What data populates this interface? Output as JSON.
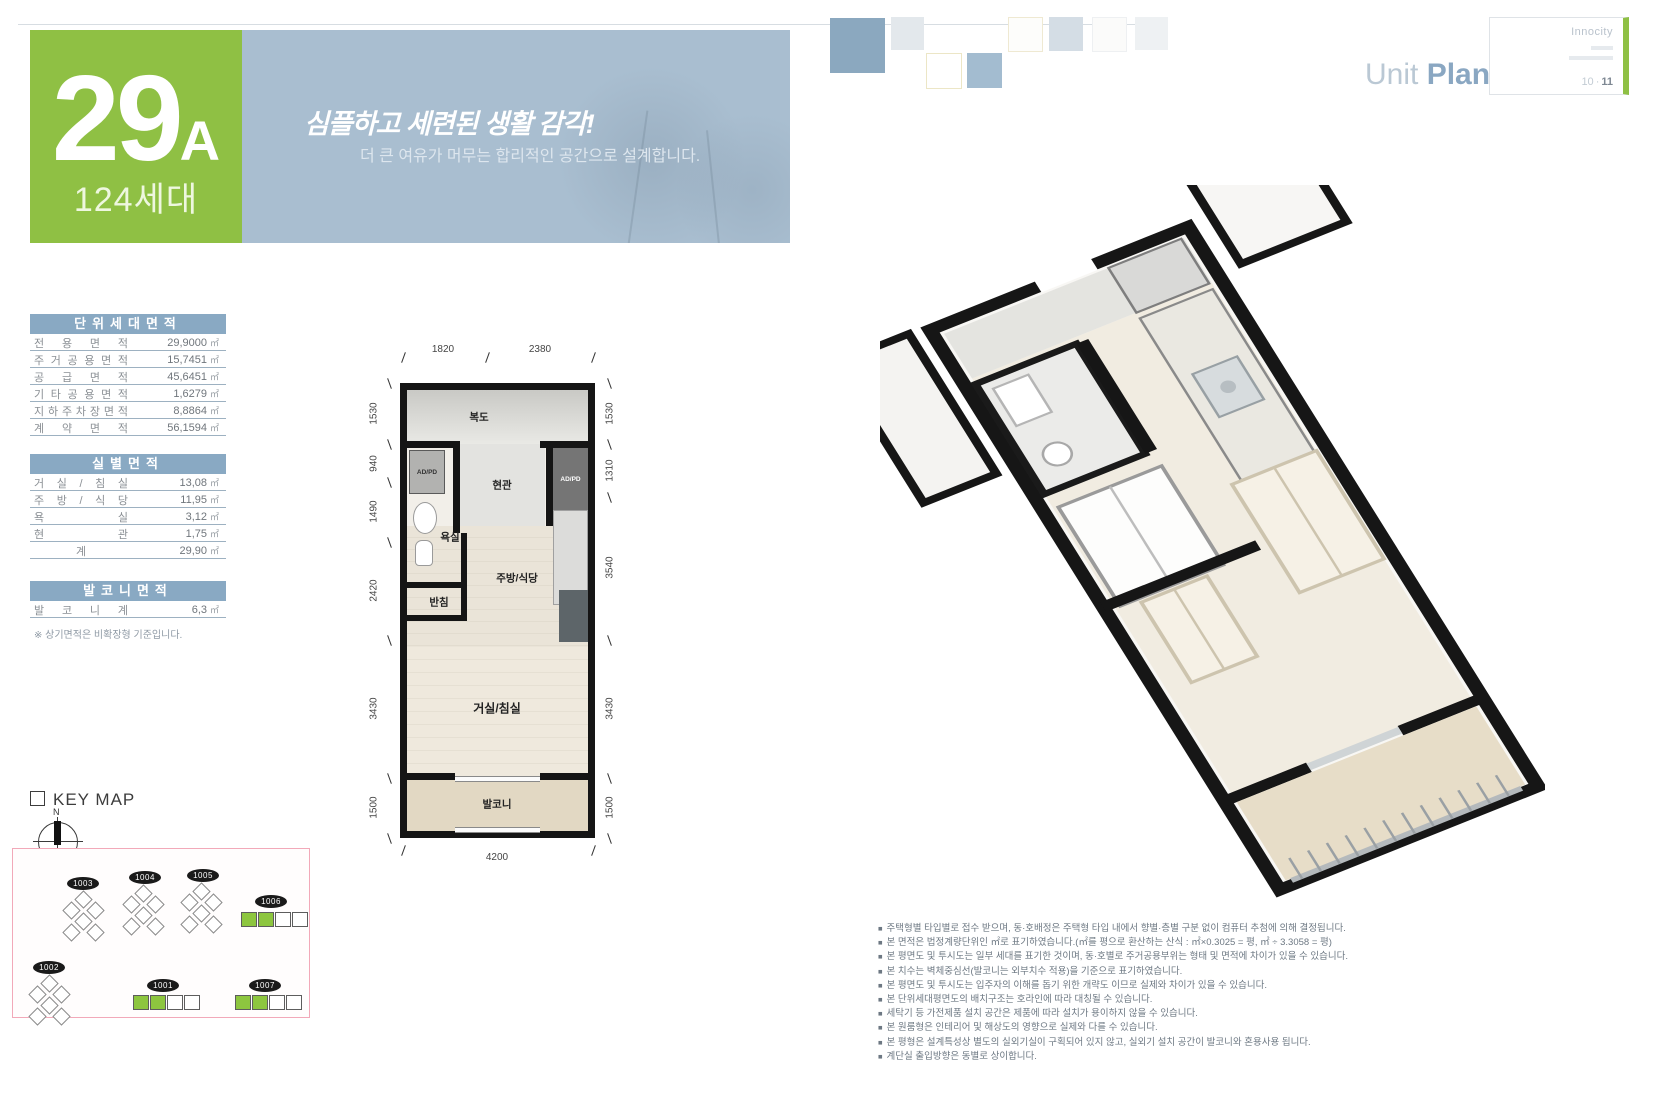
{
  "badge": {
    "number": "29",
    "letter": "A",
    "households": "124세대"
  },
  "banner": {
    "headline": "심플하고 세련된 생활 감각!",
    "subline": "더 큰 여유가 머무는 합리적인 공간으로 설계합니다."
  },
  "header": {
    "unit_word": "Unit",
    "plan_word": "Plan",
    "brand": "Innocity",
    "page_left": "10",
    "page_sep": "·",
    "page_right": "11"
  },
  "colors": {
    "accent_green": "#8fc044",
    "banner_blue": "#a9bed0",
    "table_header_blue": "#89a9c3"
  },
  "tables": {
    "unit": {
      "title": "단위세대면적",
      "rows": [
        {
          "label": "전 용 면 적",
          "value": "29,9000",
          "unit": "㎡"
        },
        {
          "label": "주 거 공 용 면 적",
          "value": "15,7451",
          "unit": "㎡"
        },
        {
          "label": "공 급 면 적",
          "value": "45,6451",
          "unit": "㎡"
        },
        {
          "label": "기 타 공 용 면 적",
          "value": "1,6279",
          "unit": "㎡"
        },
        {
          "label": "지 하 주 차 장 면 적",
          "value": "8,8864",
          "unit": "㎡"
        },
        {
          "label": "계 약 면 적",
          "value": "56,1594",
          "unit": "㎡"
        }
      ]
    },
    "room": {
      "title": "실별면적",
      "rows": [
        {
          "label": "거 실 / 침 실",
          "value": "13,08",
          "unit": "㎡"
        },
        {
          "label": "주 방 / 식 당",
          "value": "11,95",
          "unit": "㎡"
        },
        {
          "label": "욕 실",
          "value": "3,12",
          "unit": "㎡"
        },
        {
          "label": "현 관",
          "value": "1,75",
          "unit": "㎡"
        },
        {
          "label": "계",
          "value": "29,90",
          "unit": "㎡"
        }
      ]
    },
    "balcony": {
      "title": "발코니면적",
      "rows": [
        {
          "label": "발 코 니 계",
          "value": "6,3",
          "unit": "㎡"
        }
      ]
    },
    "note": "※ 상기면적은 비확장형 기준입니다."
  },
  "plan2d": {
    "dims_top": [
      "1820",
      "2380"
    ],
    "dims_left": [
      "1530",
      "940",
      "1490",
      "2420",
      "3430",
      "1500"
    ],
    "dims_right": [
      "1530",
      "1310",
      "3540",
      "3430",
      "1500"
    ],
    "dim_bottom": "4200",
    "rooms": {
      "corridor": "복도",
      "entrance": "현관",
      "bath": "욕실",
      "closet": "반침",
      "kitchen": "주방/식당",
      "living": "거실/침실",
      "balcony": "발코니",
      "ad_pd_left": "AD/PD",
      "ad_pd_right": "AD/PD"
    }
  },
  "keymap": {
    "title": "KEY MAP",
    "compass_label": "N",
    "buildings": [
      {
        "id": "1003"
      },
      {
        "id": "1004"
      },
      {
        "id": "1005"
      },
      {
        "id": "1006"
      },
      {
        "id": "1002"
      },
      {
        "id": "1001"
      },
      {
        "id": "1007"
      }
    ]
  },
  "notes": {
    "bullet": "■",
    "items": [
      "주택형별 타입별로 접수 받으며, 동·호배정은 주택형 타입 내에서 향별·층별 구분 없이 컴퓨터 추첨에 의해 결정됩니다.",
      "본 면적은 법정계량단위인 ㎡로 표기하였습니다.(㎡를 평으로 환산하는 산식 : ㎡×0.3025 = 평, ㎡ ÷ 3.3058 = 평)",
      "본 평면도 및 투시도는 일부 세대를 표기한 것이며, 동·호별로 주거공용부위는 형태 및 면적에 차이가 있을 수 있습니다.",
      "본 치수는 벽체중심선(발코니는 외부치수 적용)을 기준으로 표기하였습니다.",
      "본 평면도 및 투시도는 입주자의 이해를 돕기 위한 개략도 이므로 실제와 차이가 있을 수 있습니다.",
      "본 단위세대평면도의 배치구조는 호라인에 따라 대칭될 수 있습니다.",
      "세탁기 등 가전제품 설치 공간은 제품에 따라 설치가 용이하지 않을 수 있습니다.",
      "본 원룸형은 인테리어 및 해상도의 영향으로 실제와 다를 수 있습니다.",
      "본 평형은 설계특성상 별도의 실외기실이 구획되어 있지 않고, 실외기 설치 공간이 발코니와 혼용사용 됩니다.",
      "계단실 출입방향은 동별로 상이합니다."
    ]
  }
}
